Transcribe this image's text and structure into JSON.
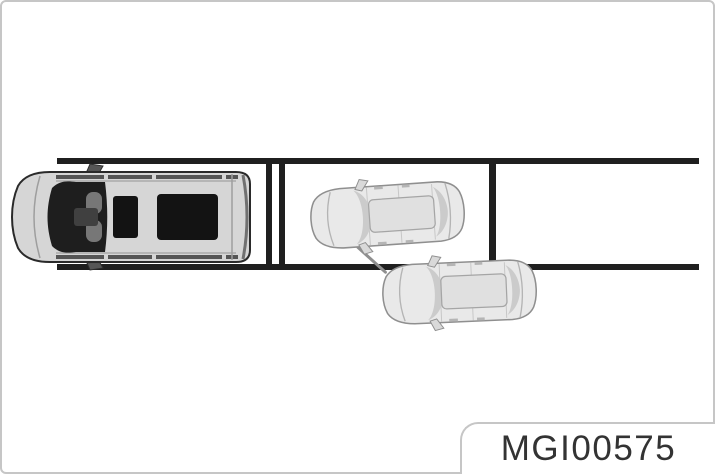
{
  "figure": {
    "label": "MGI00575"
  },
  "scene": {
    "line_color": "#1f1f1f",
    "vehicles": {
      "ego_minivan": {
        "name": "ego-minivan-top-view-icon",
        "body_color": "#d6d6d6",
        "outline_color": "#2a2a2a",
        "glass_color": "#1e1e1e",
        "sunroof_color": "#131313"
      },
      "parked_car": {
        "name": "parked-car-top-view-icon",
        "body_color": "#e9e9e9",
        "outline_color": "#8f8f8f",
        "glass_color": "#cbcbcb",
        "roof_color": "#e0e0e0"
      },
      "exiting_car": {
        "name": "exiting-car-top-view-icon",
        "body_color": "#e9e9e9",
        "outline_color": "#8f8f8f"
      }
    }
  },
  "frame": {
    "background_color": "#ffffff",
    "border_color": "#c6c6c6",
    "label_text_color": "#333333"
  }
}
